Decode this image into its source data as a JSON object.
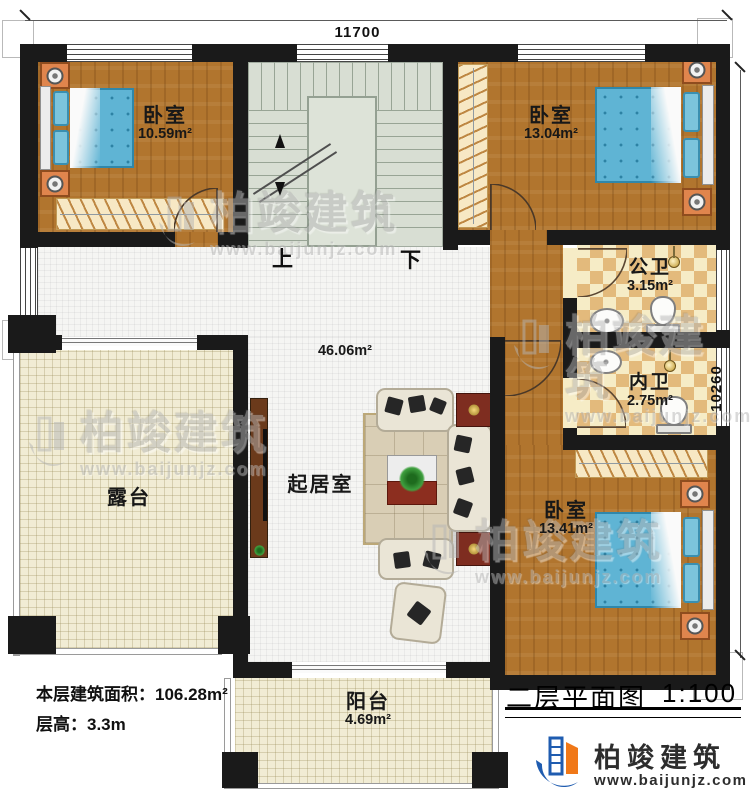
{
  "dimensions": {
    "width": "11700",
    "height": "10260"
  },
  "rooms": {
    "bedroom_top_left": {
      "label": "卧室",
      "area": "10.59m²"
    },
    "bedroom_top_right": {
      "label": "卧室",
      "area": "13.04m²"
    },
    "bedroom_bottom_right": {
      "label": "卧室",
      "area": "13.41m²"
    },
    "living_room": {
      "label": "起居室",
      "area": "46.06m²"
    },
    "public_bath": {
      "label": "公卫",
      "area": "3.15m²"
    },
    "private_bath": {
      "label": "内卫",
      "area": "2.75m²"
    },
    "terrace": {
      "label": "露台"
    },
    "balcony": {
      "label": "阳台",
      "area": "4.69m²"
    }
  },
  "stairs": {
    "up": "上",
    "down": "下"
  },
  "info": {
    "floor_area": "本层建筑面积：106.28m²",
    "floor_height": "层高：3.3m"
  },
  "title": {
    "name": "二层平面图",
    "scale": "1:100"
  },
  "brand": {
    "name": "柏竣建筑",
    "url": "www.baijunjz.com",
    "blue": "#1f5cb0",
    "orange": "#f07818"
  }
}
